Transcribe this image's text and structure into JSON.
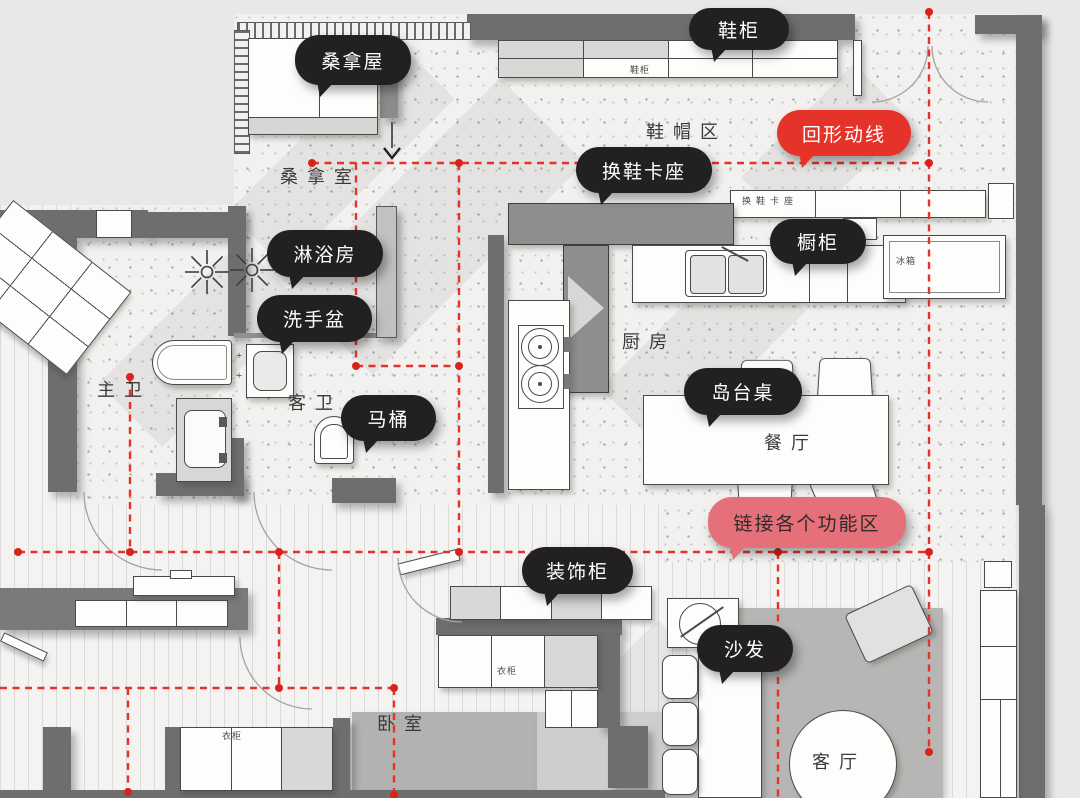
{
  "callouts": [
    {
      "label": "鞋柜",
      "type": "black"
    },
    {
      "label": "桑拿屋",
      "type": "black"
    },
    {
      "label": "回形动线",
      "type": "red"
    },
    {
      "label": "换鞋卡座",
      "type": "black"
    },
    {
      "label": "橱柜",
      "type": "black"
    },
    {
      "label": "淋浴房",
      "type": "black"
    },
    {
      "label": "洗手盆",
      "type": "black"
    },
    {
      "label": "马桶",
      "type": "black"
    },
    {
      "label": "岛台桌",
      "type": "black"
    },
    {
      "label": "链接各个功能区",
      "type": "pink"
    },
    {
      "label": "装饰柜",
      "type": "black"
    },
    {
      "label": "沙发",
      "type": "black"
    }
  ],
  "rooms": [
    {
      "label": "桑拿室"
    },
    {
      "label": "鞋帽区"
    },
    {
      "label": "厨房"
    },
    {
      "label": "餐厅"
    },
    {
      "label": "主卫"
    },
    {
      "label": "客卫"
    },
    {
      "label": "卧室"
    },
    {
      "label": "客厅"
    }
  ],
  "plan_labels": [
    {
      "text": "鞋柜"
    },
    {
      "text": "换鞋卡座"
    },
    {
      "text": "冰箱"
    },
    {
      "text": "衣柜"
    },
    {
      "text": "衣柜"
    }
  ],
  "colors": {
    "wall": "#6f6e6d",
    "bubble_black": "#232021",
    "bubble_red": "#e5332a",
    "bubble_pink": "#e5707a",
    "circulation_line": "#e5332a",
    "floor_terrazzo": "#f2f1ef",
    "floor_wood": "#f4f3f2",
    "rug": "#b7b6b4"
  }
}
